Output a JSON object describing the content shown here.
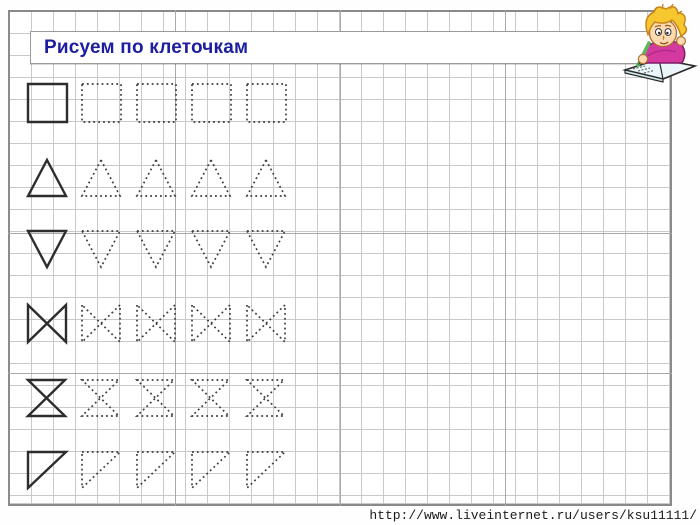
{
  "page": {
    "title": "Рисуем по клеточкам",
    "url_caption": "http://www.liveinternet.ru/users/ksu11111/"
  },
  "theme": {
    "title_color": "#1d1d9f",
    "grid_line_color": "#c9c9c9",
    "grid_major_line_color": "#a9a9a9",
    "sheet_border_color": "#8a8a8a",
    "solid_shape_color": "#2d2d2d",
    "dotted_shape_color": "#3c3c3c",
    "mascot_hair_color": "#f6c72e",
    "mascot_skin_color": "#fcd9ae",
    "mascot_shirt_color": "#d4399f",
    "mascot_pencil_color": "#5cb85c",
    "mascot_book_color": "#eaf6fa"
  },
  "grid": {
    "cell_size": 22,
    "major_vertical_x": [
      175,
      340,
      505
    ],
    "major_horizontal_y": [
      233,
      373
    ]
  },
  "worksheet": {
    "rows": [
      {
        "shape": "square",
        "y": 84,
        "w": 39,
        "h": 38,
        "solid_x": 28,
        "dotted_x": [
          82,
          137,
          192,
          247
        ]
      },
      {
        "shape": "triangle-up",
        "y": 160,
        "w": 38,
        "h": 36,
        "solid_x": 28,
        "dotted_x": [
          82,
          137,
          192,
          247
        ]
      },
      {
        "shape": "triangle-down",
        "y": 231,
        "w": 38,
        "h": 36,
        "solid_x": 28,
        "dotted_x": [
          82,
          137,
          192,
          247
        ]
      },
      {
        "shape": "bowtie",
        "y": 305,
        "w": 38,
        "h": 37,
        "solid_x": 28,
        "dotted_x": [
          82,
          137,
          192,
          247
        ]
      },
      {
        "shape": "hourglass",
        "y": 380,
        "w": 37,
        "h": 36,
        "solid_x": 28,
        "dotted_x": [
          82,
          137,
          192,
          247
        ]
      },
      {
        "shape": "right-triangle",
        "y": 452,
        "w": 38,
        "h": 36,
        "solid_x": 28,
        "dotted_x": [
          82,
          137,
          192,
          247
        ]
      }
    ]
  }
}
